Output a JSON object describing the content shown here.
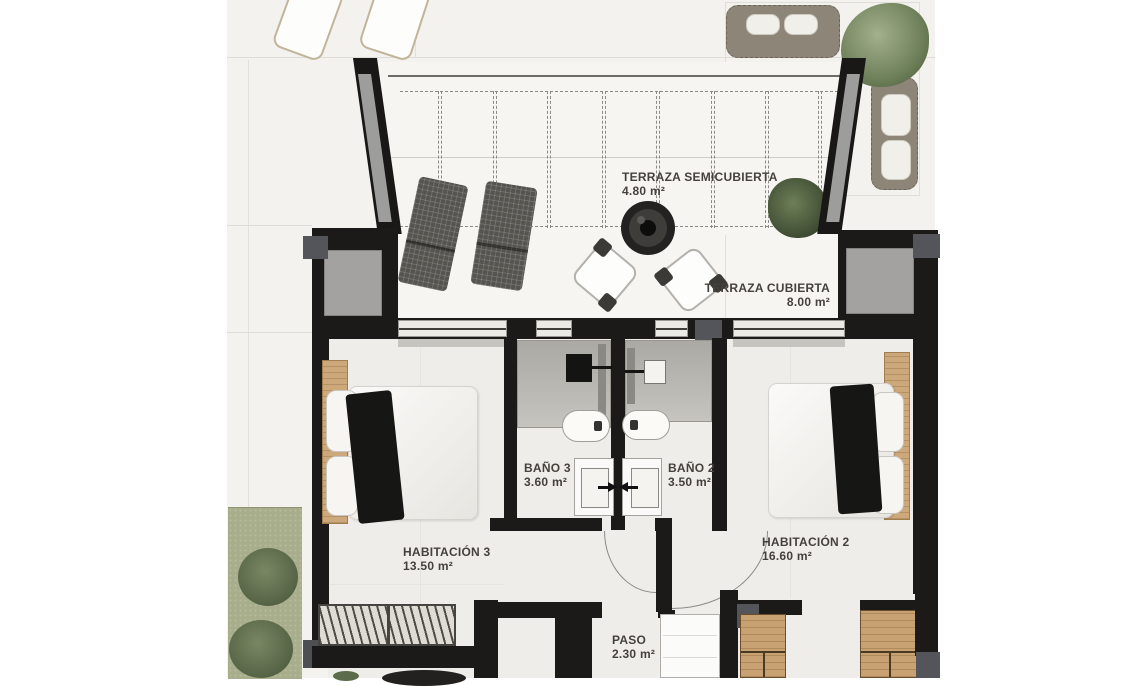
{
  "rooms": [
    {
      "name": "TERRAZA SEMICUBIERTA",
      "area": "4.80 m²"
    },
    {
      "name": "TERRAZA CUBIERTA",
      "area": "8.00 m²"
    },
    {
      "name": "BAÑO 3",
      "area": "3.60 m²"
    },
    {
      "name": "BAÑO 2",
      "area": "3.50 m²"
    },
    {
      "name": "HABITACIÓN 3",
      "area": "13.50 m²"
    },
    {
      "name": "HABITACIÓN 2",
      "area": "16.60 m²"
    },
    {
      "name": "PASO",
      "area": "2.30 m²"
    }
  ],
  "colors": {
    "wall": "#1b1a18",
    "floor_exterior": "#f3f2ee",
    "floor_interior": "#efede9",
    "terrace_floor": "#f6f5f2",
    "glass": "#9d9d9b",
    "shower_floor": "#b4b2ad",
    "wood": "#c9a273",
    "grass": "#a8ad8b",
    "bush": "#6d7b59",
    "sofa": "#8d8678",
    "label_text": "#45423d"
  },
  "furniture": [
    "sun-lounger",
    "garden-sofa",
    "tree",
    "deck-lounger",
    "fire-table",
    "lounge-chair",
    "potted-plant",
    "double-bed",
    "walk-in-shower",
    "toilet",
    "washbasin",
    "wardrobe",
    "closet",
    "stair-panel"
  ]
}
